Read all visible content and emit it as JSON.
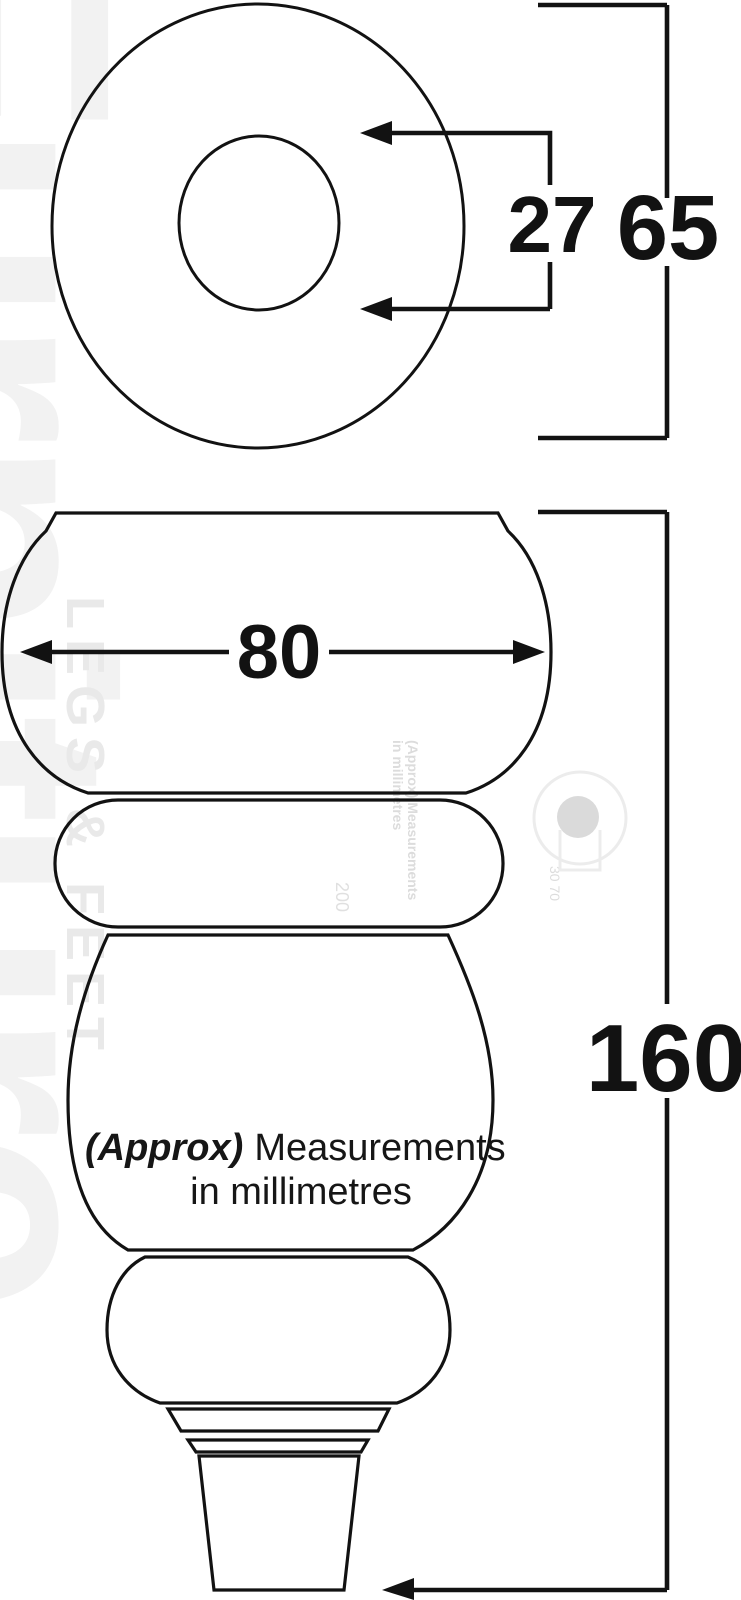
{
  "labels": {
    "inner_diameter": "27",
    "outer_diameter": "65",
    "body_width": "80",
    "total_height": "160"
  },
  "note": {
    "approx": "(Approx)",
    "line1_rest": "Measurements",
    "line2": "in millimetres"
  },
  "watermark": {
    "brand": "Furniture",
    "legs_feet": "LEGS & FEET",
    "tiny_line1": "(Approx) Measurements",
    "tiny_line2": "in millimetres",
    "num_left": "200",
    "num_logo": "30 70"
  },
  "colors": {
    "line": "#121212",
    "background": "#ffffff",
    "watermark": "#f2f2f2"
  }
}
